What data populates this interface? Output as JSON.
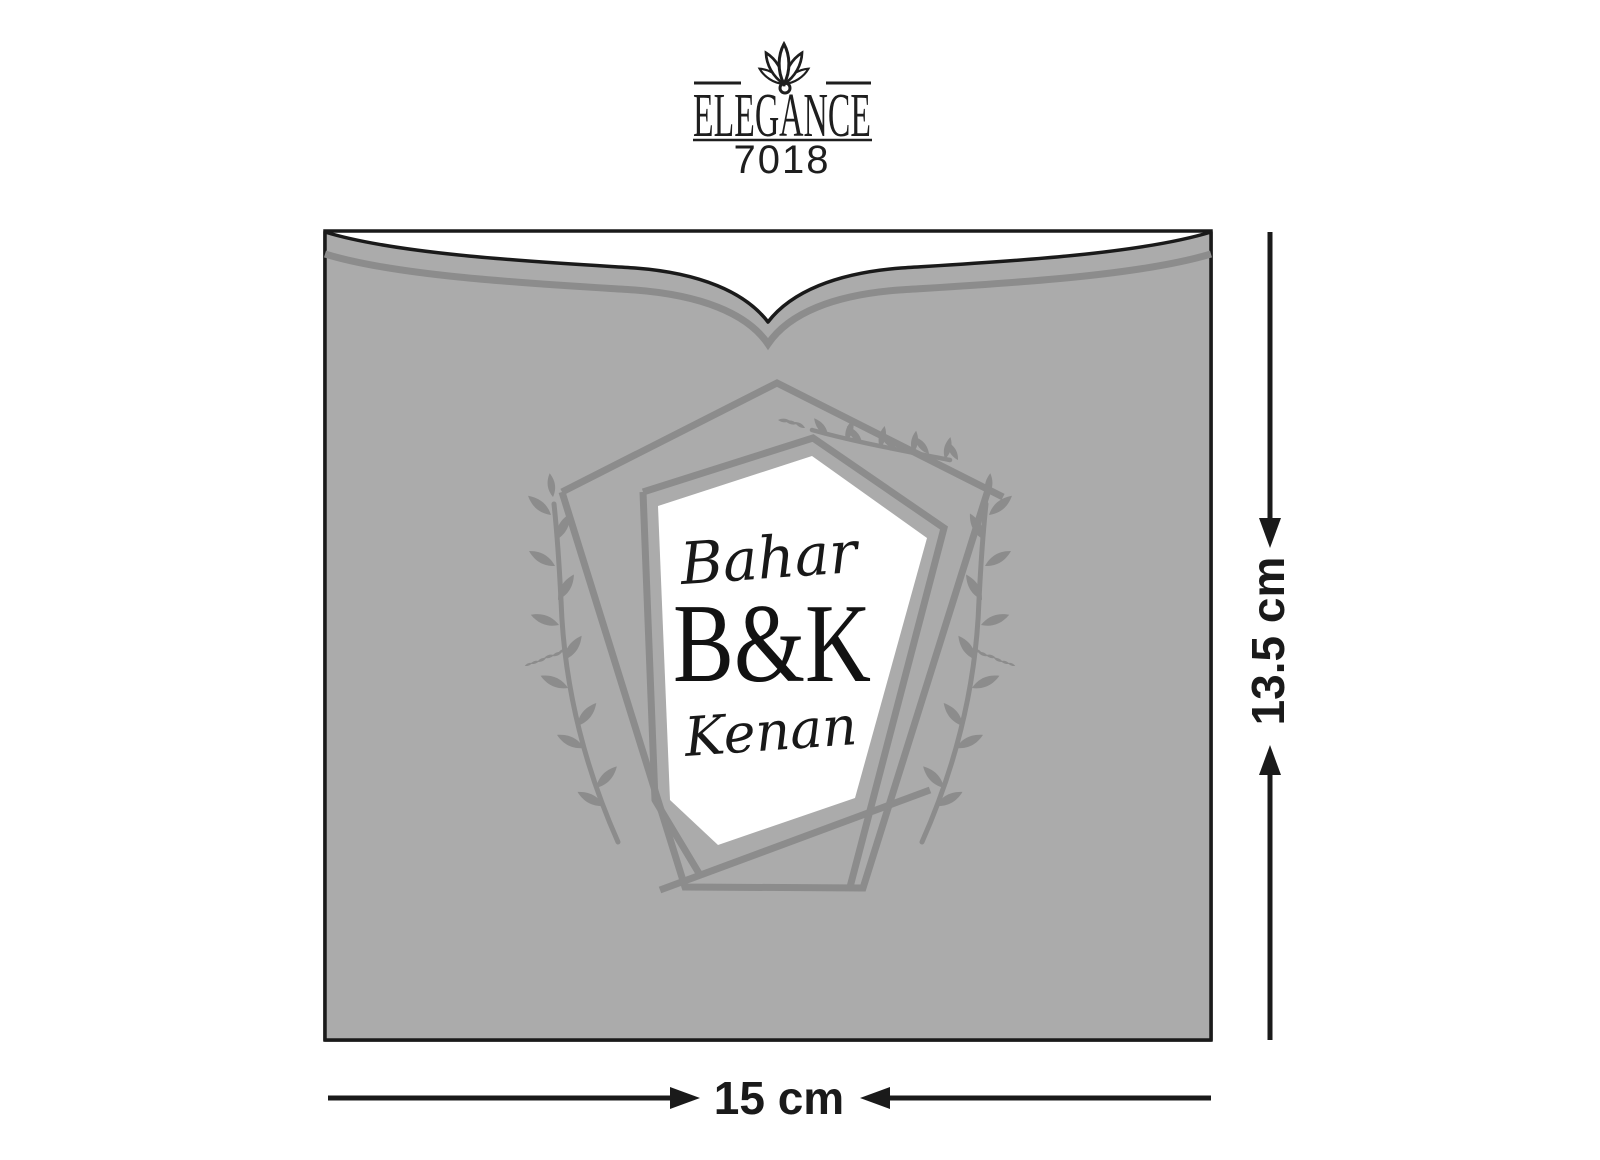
{
  "brand": {
    "name": "ELEGANCE",
    "code": "7018",
    "icon": "lotus"
  },
  "monogram": {
    "bride": "Bahar",
    "initials": "B&K",
    "groom": "Kenan"
  },
  "dimensions": {
    "height_label": "13.5 cm",
    "width_label": "15 cm"
  },
  "colors": {
    "background": "#FFFFFF",
    "panel_white": "#FFFFFF",
    "pocket_gray": "#ABABAB",
    "ornament_gray": "#8C8C8C",
    "outline_black": "#1A1A1A",
    "text_black": "#181818"
  }
}
